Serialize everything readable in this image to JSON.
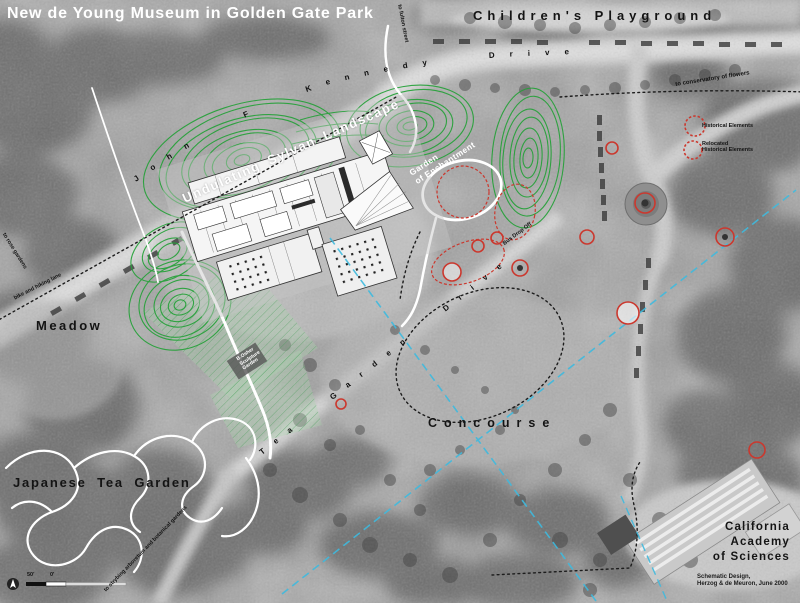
{
  "map": {
    "title": "New de Young Museum in Golden Gate Park",
    "areas": {
      "childrens_playground": "Children's Playground",
      "meadow": "Meadow",
      "japanese_tea_garden": "Japanese Tea Garden",
      "concourse": "Concourse",
      "undulating_sylvan_landscape": "Undulating Sylvan Landscape",
      "garden_of_enchantment_line1": "Garden",
      "garden_of_enchantment_line2": "of Enchantment",
      "california_academy_line1": "California",
      "california_academy_line2": "Academy",
      "california_academy_line3": "of Sciences",
      "sculpture_garden_line1": "B.Osher",
      "sculpture_garden_line2": "Sculpture",
      "sculpture_garden_line3": "Garden"
    },
    "roads": {
      "jfk_drive": "John F Kennedy Drive",
      "tea_garden_drive": "Tea Garden Drive"
    },
    "directions": {
      "to_conservatory": "to conservatory of flowers",
      "to_rose_gardens": "to rose gardens",
      "bike_lane": "bike and hiking lane",
      "to_fulton": "to fulton street",
      "to_strybing": "to strybing arboretum and botanical gardens",
      "bus_drop_off": "Bus Drop Off"
    },
    "legend": {
      "historical": "Historical Elements",
      "relocated_line1": "Relocated",
      "relocated_line2": "Historical Elements"
    },
    "credits": {
      "line1": "Schematic Design,",
      "line2": "Herzog & de Meuron, June 2000"
    },
    "scale": {
      "label_50": "50'",
      "label_0": "0'"
    },
    "colors": {
      "contour_green": "#24a138",
      "marker_red": "#cb382e",
      "axis_blue": "#3fbade",
      "hatch_green": "#3f9a52"
    }
  }
}
